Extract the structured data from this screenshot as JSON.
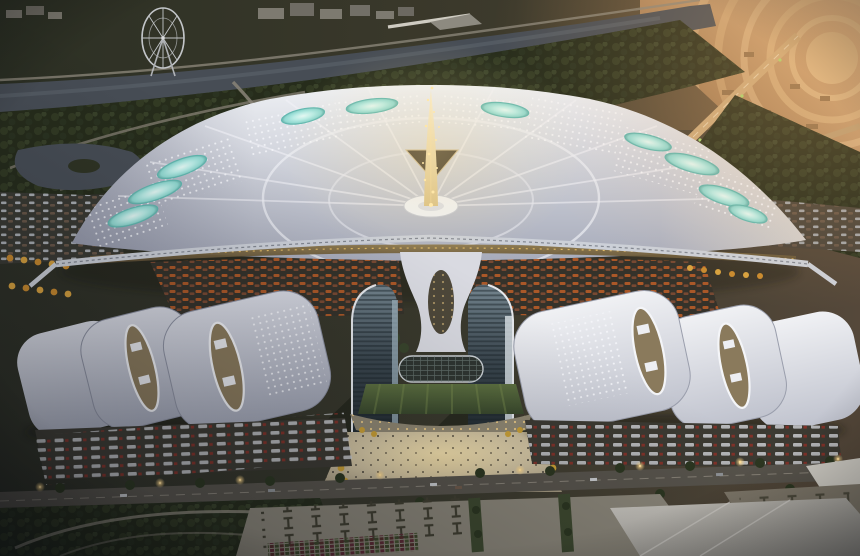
{
  "scene": {
    "type": "architectural-aerial-rendering",
    "description": "Aerial dusk rendering of a fan-shaped convention and exhibition center: radiating white roof petals with glowing teal skylights around a golden central spire, twin blue glass towers over a green courtyard and bright plaza, shingled white exhibition halls with oval skylights on both flanks, truck docks, tree-lined boulevard, parking lots, a river with a ferris wheel park at top-left and warm sunset-lit circular roads at top-right",
    "time_of_day": "dusk",
    "view": "high oblique aerial"
  },
  "palette": {
    "trees_dark": "#262c1b",
    "trees_texture": "#333b24",
    "water": "#474d55",
    "water_light": "#626a74",
    "amber_light": "#dcb387",
    "amber_deep": "#6b5540",
    "roof_white": "#d8dae2",
    "roof_shadow": "#9ca0af",
    "skylight_teal": "#8fd8d0",
    "skylight_teal_bright": "#e4f8f4",
    "spire_gold": "#ffe9ad",
    "glow_gold": "#e8c06a",
    "glass_dark": "#2b353c",
    "glass_light": "#9fb3bd",
    "lawn_green": "#55683c",
    "plaza_warm": "#e6d7ae",
    "ground_olive": "#3a3a2e",
    "road_grey": "#57534b",
    "dock_dark": "#3c3a32",
    "truck_white": "#c9cbce",
    "car_orange": "#b05a28",
    "lamp_glow": "#ffd98c"
  },
  "features": [
    "river",
    "ferris-wheel",
    "lagoon",
    "distant-buildings",
    "fan-terminal-roof",
    "teal-skylights",
    "central-spire",
    "hub-disc",
    "elevated-walkway",
    "parking-lots",
    "glass-tower-left",
    "glass-tower-right",
    "central-canopy",
    "atrium-roof",
    "courtyard-lawn",
    "terrace-steps",
    "festival-plaza",
    "exhibition-halls-left",
    "exhibition-halls-right",
    "oval-skylights",
    "truck-docks",
    "boulevard",
    "street-lamps",
    "sunset-ring-roads",
    "flat-roof-building",
    "parking-plaza",
    "park-paths"
  ]
}
